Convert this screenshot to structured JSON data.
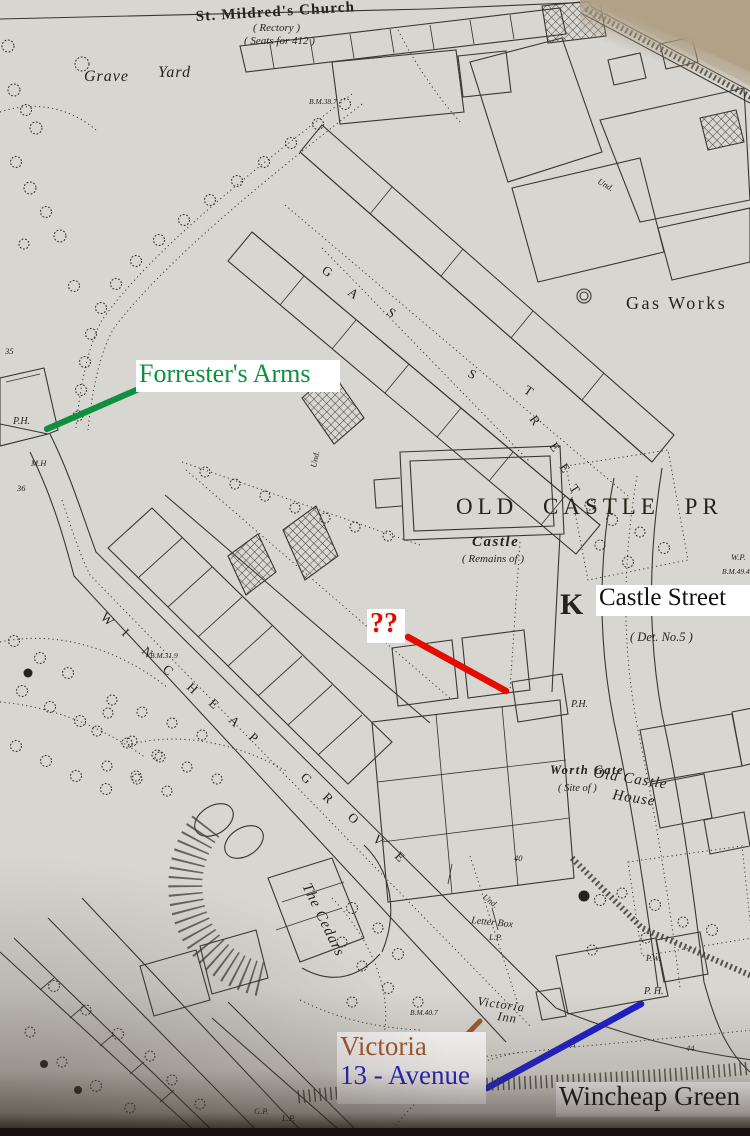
{
  "annotations": {
    "forresters_arms": {
      "label": "Forrester's Arms",
      "color": "#0f8f3f"
    },
    "query": {
      "label": "??",
      "color": "#e40b00"
    },
    "castle_street": {
      "label": "Castle Street",
      "color": "#121212"
    },
    "victoria": {
      "label": "Victoria",
      "color": "#a8572b"
    },
    "avenue": {
      "label": "13 - Avenue",
      "color": "#1d1cc9"
    },
    "wincheap_green": {
      "label": "Wincheap Green",
      "color": "#121212"
    }
  },
  "map_labels": {
    "church": "St. Mildred's Church",
    "rectory": "( Rectory )",
    "seats": "( Seats for 412 )",
    "grave": "Grave",
    "yard": "Yard",
    "gas_works": "Gas Works",
    "old_castle_precincts": "OLD CASTLE PR",
    "castle": "Castle",
    "remains": "( Remains of )",
    "det_no": "( Det. No.5 )",
    "gothic_k": "K",
    "worth_gate": "Worth Gate",
    "site_of": "( Site of )",
    "old_castle_house_line1": "Old Castle",
    "old_castle_house_line2": "House",
    "the_cedars": "The Cedars",
    "victoria_inn_line1": "Victoria",
    "victoria_inn_line2": "Inn",
    "letter_box": "Letter Box",
    "gas_street": [
      "G",
      "A",
      "S",
      "S",
      "T",
      "R",
      "E",
      "E",
      "T"
    ],
    "wincheap": [
      "W",
      "I",
      "N",
      "C",
      "H",
      "E",
      "A",
      "P"
    ],
    "grove": [
      "G",
      "R",
      "O",
      "V",
      "E"
    ],
    "ph": "P.H.",
    "ph2": "P.H.",
    "ph3": "P. H.",
    "pw": "P.W.",
    "wp": "W.P.",
    "mh": "M.H",
    "und": "Und.",
    "und2": "Und.",
    "und3": "Und.",
    "lp": "L.P.",
    "lp2": "L.P.",
    "gp": "G.P.",
    "bm_387": "B.M.38.7",
    "bm_319": "B.M.31.9",
    "bm_407": "B.M.40.7",
    "bm_494": "B.M.49.4",
    "n35": "35",
    "n36": "36",
    "n40": "40",
    "n43": "43",
    "n44": "44"
  }
}
